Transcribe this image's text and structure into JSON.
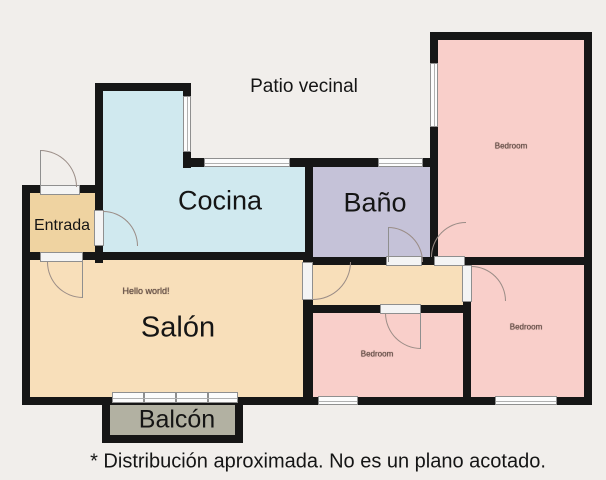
{
  "patio": {
    "label": "Patio vecinal"
  },
  "footnote": "* Distribución aproximada. No es un plano acotado.",
  "rooms": {
    "cocina": {
      "label": "Cocina"
    },
    "bano": {
      "label": "Baño"
    },
    "entrada": {
      "label": "Entrada"
    },
    "salon": {
      "label": "Salón",
      "annotation": "Hello world!"
    },
    "balcon": {
      "label": "Balcón"
    },
    "bedroom_top_right": {
      "label": "Bedroom"
    },
    "bedroom_bottom_center": {
      "label": "Bedroom"
    },
    "bedroom_bottom_right": {
      "label": "Bedroom"
    }
  },
  "colors": {
    "background": "#f1eeeb",
    "wall": "#161616",
    "cocina": "#d0e9ef",
    "bano": "#c5c2d8",
    "entrada": "#efd3a1",
    "salon_hall": "#f8dfba",
    "bedroom": "#f9cfca",
    "balcon": "#b2b1a2",
    "window": "#fcfcfc",
    "door_arc": "#9a8c86"
  }
}
